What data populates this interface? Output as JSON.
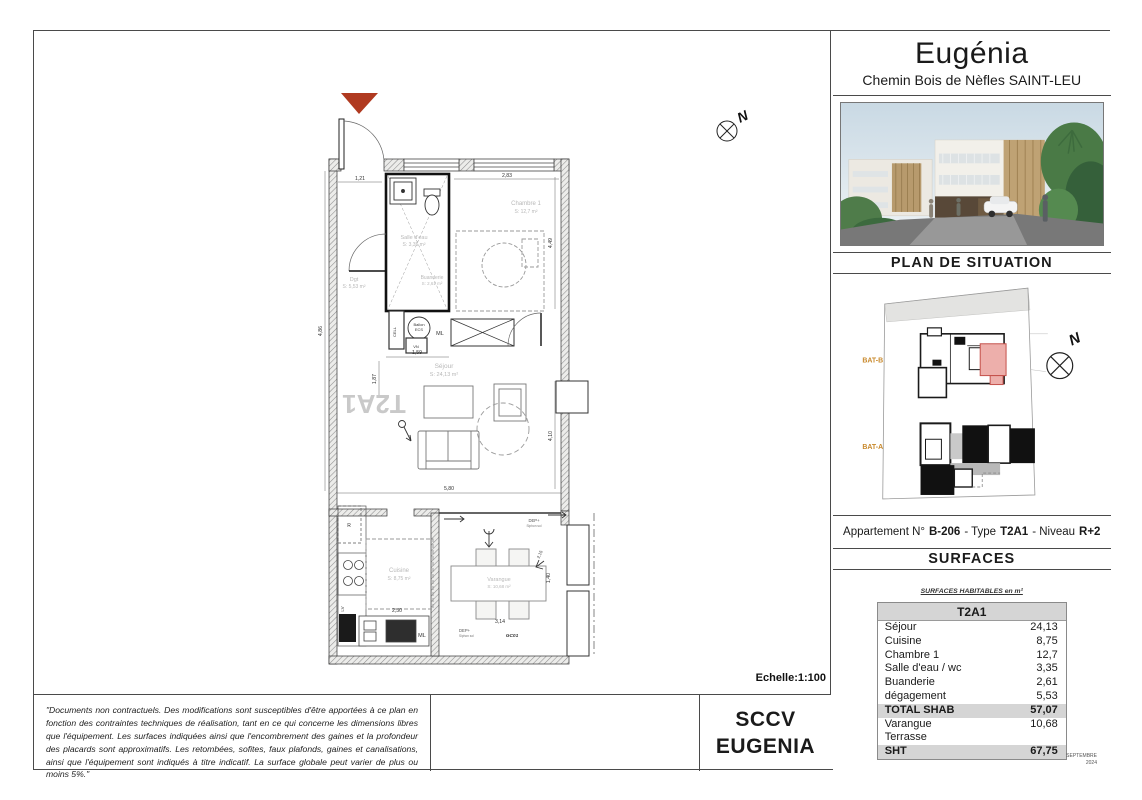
{
  "header": {
    "title": "Eugénia",
    "subtitle": "Chemin Bois de Nèfles SAINT-LEU"
  },
  "situation": {
    "title": "PLAN DE SITUATION",
    "bat_b": "BAT-B",
    "bat_a": "BAT-A",
    "north": "N"
  },
  "apartment": {
    "prefix": "Appartement N°",
    "number": "B-206",
    "sep1": "- Type",
    "type": "T2A1",
    "sep2": "- Niveau",
    "level": "R+2"
  },
  "surfaces": {
    "title": "SURFACES",
    "table_title": "SURFACES HABITABLES en m²",
    "header": "T2A1",
    "rows": [
      {
        "label": "Séjour",
        "value": "24,13",
        "emphasis": false
      },
      {
        "label": "Cuisine",
        "value": "8,75",
        "emphasis": false
      },
      {
        "label": "Chambre 1",
        "value": "12,7",
        "emphasis": false
      },
      {
        "label": "Salle d'eau / wc",
        "value": "3,35",
        "emphasis": false
      },
      {
        "label": "Buanderie",
        "value": "2,61",
        "emphasis": false
      },
      {
        "label": "dégagement",
        "value": "5,53",
        "emphasis": false
      },
      {
        "label": "TOTAL SHAB",
        "value": "57,07",
        "emphasis": true
      },
      {
        "label": "Varangue",
        "value": "10,68",
        "emphasis": false
      },
      {
        "label": "Terrasse",
        "value": "",
        "emphasis": false
      },
      {
        "label": "SHT",
        "value": "67,75",
        "emphasis": true
      }
    ],
    "date_line1": "SEPTEMBRE",
    "date_line2": "2024"
  },
  "scale": "Echelle:1:100",
  "footer": {
    "disclaimer": "\"Documents non contractuels. Des modifications sont susceptibles d'être apportées à ce plan en fonction des contraintes techniques de réalisation, tant en ce qui concerne les dimensions libres que l'équipement. Les surfaces indiquées ainsi que l'encombrement des gaines et la profondeur des placards sont approximatifs. Les retombées, sofites, faux plafonds, gaines et canalisations, ainsi que l'équipement sont indiqués à titre indicatif. La surface globale peut varier de plus ou moins 5%.\"",
    "company_line1": "SCCV",
    "company_line2": "EUGENIA"
  },
  "plan": {
    "unit_type": "T2A1",
    "north": "N",
    "labels": {
      "chambre": "Chambre 1",
      "chambre_area": "S: 12,7 m²",
      "salle_eau": "Salle d'eau",
      "salle_eau_area": "S: 3,35 m²",
      "dgt": "Dgt",
      "dgt_area": "S: 5,53 m²",
      "buanderie": "Buanderie",
      "buanderie_area": "S: 2,61 m²",
      "sejour": "Séjour",
      "sejour_area": "S: 24,13 m²",
      "cuisine": "Cuisine",
      "cuisine_area": "S: 8,75 m²",
      "varangue": "Varangue",
      "varangue_area": "S: 10,68 m²",
      "ballon1": "Ballon",
      "ballon2": "ECS",
      "cell": "CELL",
      "vn": "VN",
      "ml": "ML",
      "ml2": "ML",
      "fridge": "R",
      "lv": "LV",
      "dep1": "DEP+",
      "dep1b": "Siphon sol",
      "dep2": "DEP+",
      "dep2b": "Siphon sol",
      "gc01": "GC01"
    },
    "dims": {
      "d121": "1,21",
      "d283": "2,83",
      "d449": "4,49",
      "d486": "4,86",
      "d159": "1,59",
      "d187": "1,87",
      "d580": "5,80",
      "d410": "4,10",
      "d250": "2,50",
      "d314": "3,14",
      "d140": "1,40",
      "d215": "2,15"
    }
  }
}
